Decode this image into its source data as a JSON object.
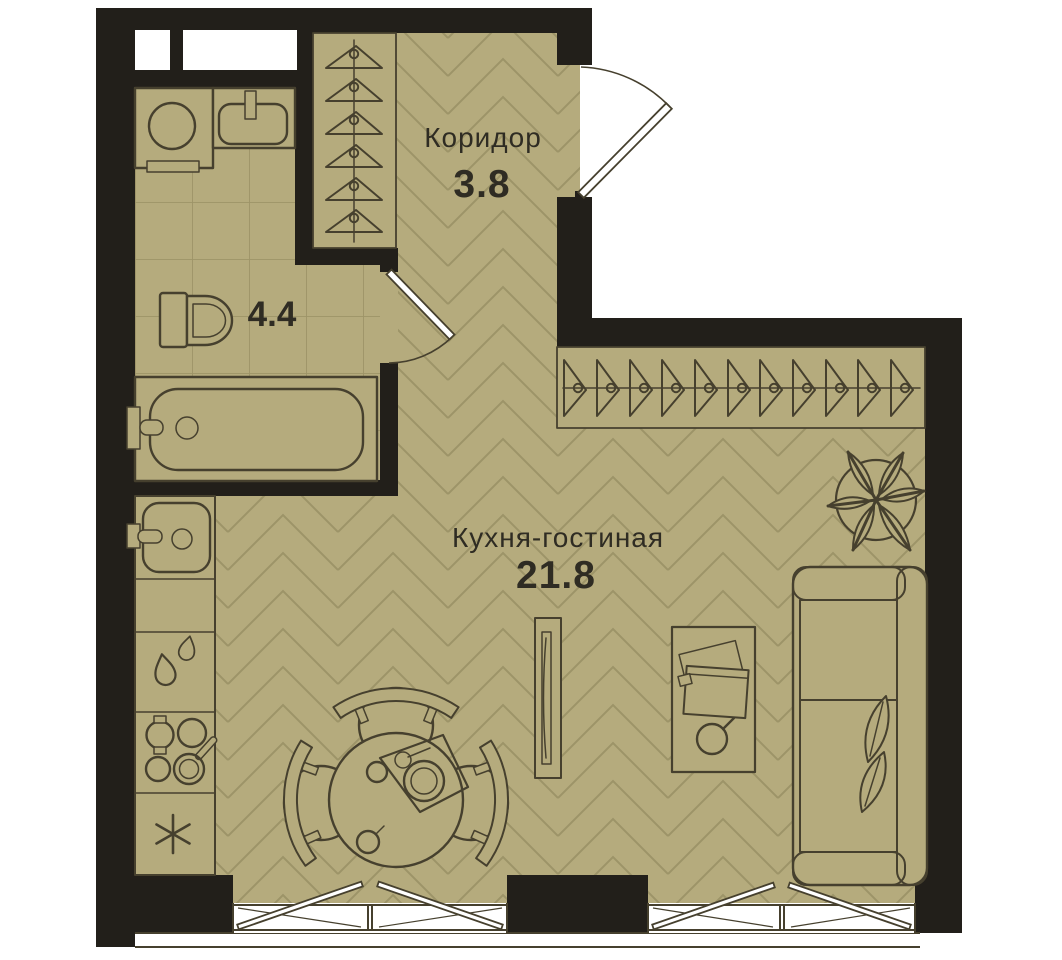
{
  "plan": {
    "rooms": {
      "corridor": {
        "name": "Коридор",
        "area": "3.8"
      },
      "bathroom": {
        "name": "",
        "area": "4.4"
      },
      "kitchen_living": {
        "name": "Кухня-гостиная",
        "area": "21.8"
      }
    }
  },
  "theme": {
    "floor": "#b5ab7d",
    "floor_line": "#9d9468",
    "wall": "#221f1a",
    "outline": "#46402e",
    "text": "#2f2c23",
    "paper": "#ffffff"
  }
}
